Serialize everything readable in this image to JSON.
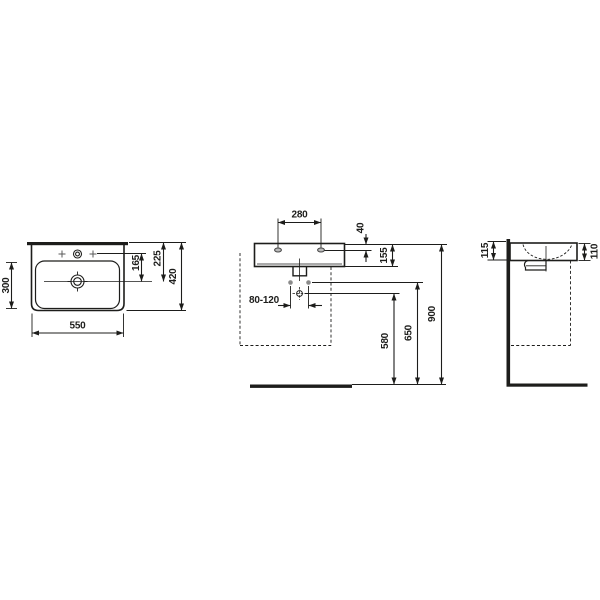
{
  "drawing": {
    "type": "washbasin-installation-technical-drawing",
    "colors": {
      "line": "#1d1d1b",
      "mounting_dot": "#8a8a8a",
      "background": "#ffffff"
    },
    "views": {
      "top_view": {
        "dims": {
          "width": "550",
          "basin_depth": "300",
          "total_depth": "420",
          "tap_to_drain": "165",
          "back_to_drain": "225"
        }
      },
      "front_view": {
        "dims": {
          "tap_hole_spacing": "280",
          "tap_hole_offset": "40",
          "basin_height": "155",
          "drain_offset_range": "80-120",
          "trap_outlet_height": "580",
          "bolt_height": "650",
          "rim_height": "900"
        }
      },
      "side_view": {
        "dims": {
          "back_height": "115",
          "front_height": "110"
        }
      }
    }
  }
}
